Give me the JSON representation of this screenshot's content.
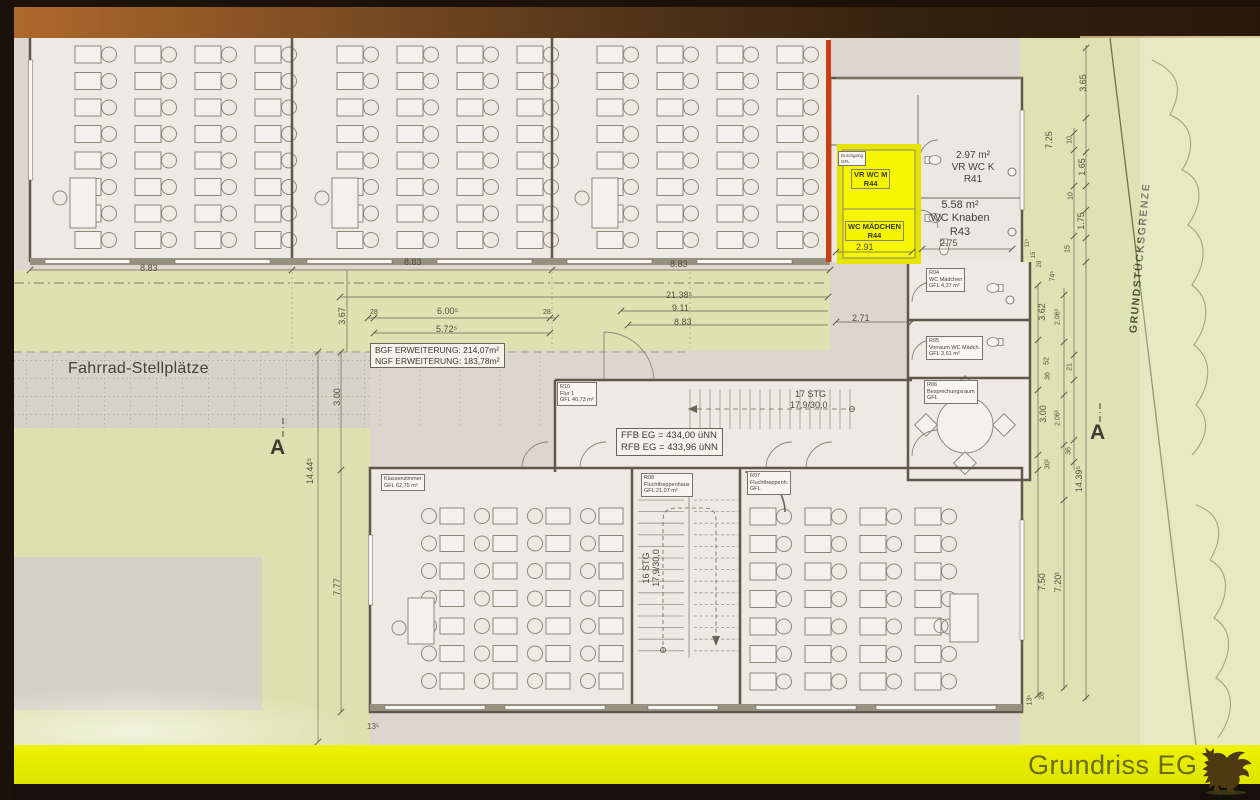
{
  "footer": {
    "title": "Grundriss EG"
  },
  "labels": {
    "fahrrad": "Fahrrad-Stellplätze",
    "bgf": "BGF ERWEITERUNG: 214,07m²",
    "ngf": "NGF ERWEITERUNG: 183,78m²",
    "ffb": "FFB EG = 434,00 üNN",
    "rfb": "RFB EG = 433,96 üNN",
    "boundary": "GRUNDSTÜCKSGRENZE",
    "section_a_left": "A",
    "section_a_right": "A"
  },
  "stairs": {
    "top_count": "17 STG",
    "top_dim": "17,9/30,0",
    "bottom_count": "16 STG",
    "bottom_dim": "17,9/30,0"
  },
  "rooms": {
    "vr_wc_m": {
      "name": "VR WC M",
      "nr": "R44"
    },
    "wc_maedchen": {
      "name": "WC MÄDCHEN",
      "nr": "R44"
    },
    "vr_wc_k": {
      "area": "2.97 m²",
      "name": "VR WC K",
      "nr": "R41"
    },
    "wc_knaben": {
      "area": "5.58 m²",
      "name": "WC Knaben",
      "nr": "R43"
    },
    "durchgang": {
      "name": "Durchgang",
      "gfl": "GFL"
    },
    "r04": {
      "nr": "R04",
      "name": "WC Mädchen",
      "gfl": "GFL 4,37 m²"
    },
    "r05": {
      "nr": "R05",
      "name": "Vorraum WC Mädch.",
      "gfl": "GFL 3,61 m²"
    },
    "r06": {
      "nr": "R06",
      "name": "Besprechungsraum",
      "gfl": "GFL"
    },
    "r10": {
      "nr": "R10",
      "name": "Flur 1",
      "gfl": "GFL 40,73 m²"
    },
    "r08": {
      "nr": "R08",
      "name": "Fluchttreppenhaus",
      "gfl": "GFL 21,07 m²"
    },
    "r07": {
      "nr": "R07",
      "name": "Fluchttreppenh.",
      "gfl": "GFL"
    },
    "klassenzimmer": {
      "name": "Klassenzimmer",
      "gfl": "GFL 62,75 m²"
    }
  },
  "dims": {
    "t883a": "8.83",
    "t883b": "8.83",
    "t883c": "8.83",
    "t2138": "21.38⁵",
    "t911": "9.11",
    "t883d": "8.83",
    "t28a": "28",
    "t600": "6.00⁵",
    "t28b": "28",
    "t572": "5.72⁵",
    "t367": "3.67",
    "t271": "2.71",
    "t291": "2.91",
    "t275": "2.75",
    "r365": "3.65",
    "r725": "7.25",
    "r10a": "10",
    "r165": "1.65",
    "r10b": "10",
    "r175": "1.75",
    "r15": "15",
    "r115": "11⁵",
    "r15b": "15",
    "r28a": "28",
    "r745": "74⁵",
    "r362": "3.62",
    "r2063": "2.06³",
    "r52": "52",
    "r36a": "36",
    "r21": "21",
    "r300": "3.00",
    "r2061": "2.06¹",
    "r36b": "36",
    "r301": "30¹",
    "r1439": "14.39⁵",
    "r750": "7.50",
    "r7201": "7.20¹",
    "r135": "13⁵",
    "r28b": "28",
    "l1444": "14.44⁵",
    "l300": "3.00",
    "l777": "7.77",
    "b135": "13⁵"
  }
}
